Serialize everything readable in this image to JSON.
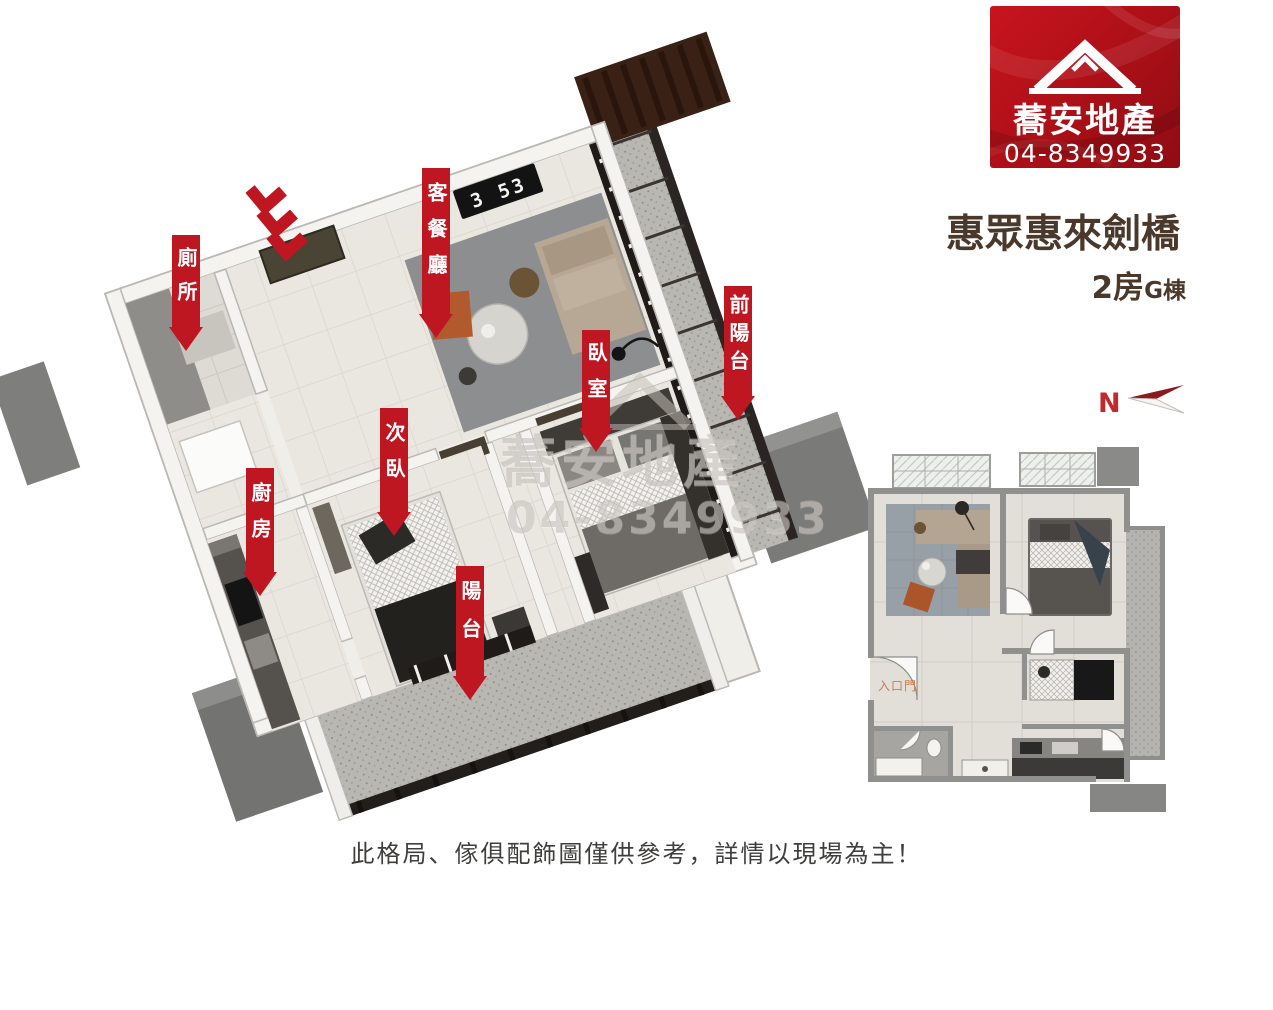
{
  "brand": {
    "name": "蕎安地產",
    "phone": "04-8349933"
  },
  "listing": {
    "title": "惠眾惠來劍橋",
    "rooms": "2房",
    "building": "G棟"
  },
  "compass": {
    "north": "N"
  },
  "plan3d": {
    "clock": "3 53",
    "labels": [
      {
        "name": "toilet",
        "text": "廁所"
      },
      {
        "name": "living-dining",
        "text": "客餐廳"
      },
      {
        "name": "bedroom",
        "text": "臥室"
      },
      {
        "name": "front-balcony",
        "text": "前陽台"
      },
      {
        "name": "second-bedroom",
        "text": "次臥"
      },
      {
        "name": "kitchen",
        "text": "廚房"
      },
      {
        "name": "balcony",
        "text": "陽台"
      }
    ],
    "watermark": {
      "line1": "蕎安地產",
      "line2": "04-8349933"
    }
  },
  "plan2d": {
    "entrance_label": "入口門"
  },
  "footer": {
    "disclaimer": "此格局、傢俱配飾圖僅供參考，詳情以現場為主！"
  },
  "colors": {
    "accent_red": "#bf1722",
    "title_brown": "#4a392b",
    "badge_red": "#b01018"
  }
}
